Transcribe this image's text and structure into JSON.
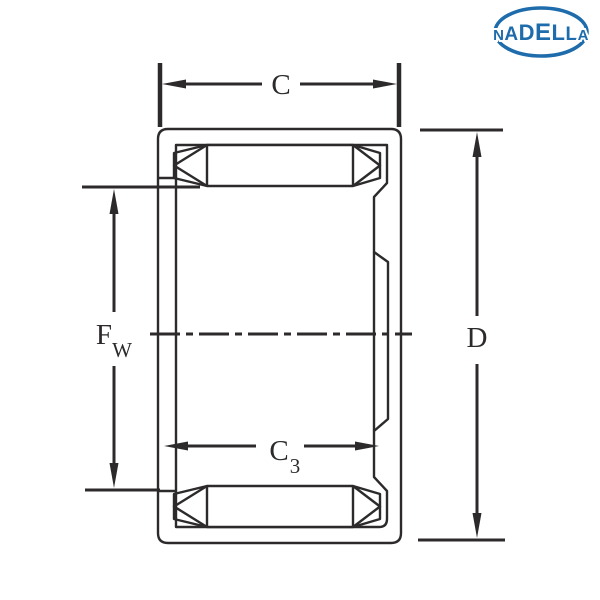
{
  "diagram": {
    "type": "technical-drawing-bearing-cross-section",
    "logo": {
      "text": "NADELLA",
      "color": "#1e6cab"
    },
    "dimensions": {
      "outer_width": {
        "main": "C",
        "sub": ""
      },
      "outer_diameter": {
        "main": "D",
        "sub": ""
      },
      "roller_bore": {
        "main": "F",
        "sub": "W"
      },
      "inner_width": {
        "main": "C",
        "sub": "3"
      }
    },
    "colors": {
      "line": "#2d2a2b",
      "hatch_base": "#e8e8ea",
      "hatch_stripe": "#ffffff",
      "roller_fill": "#ffffff",
      "background": "#ffffff"
    }
  }
}
